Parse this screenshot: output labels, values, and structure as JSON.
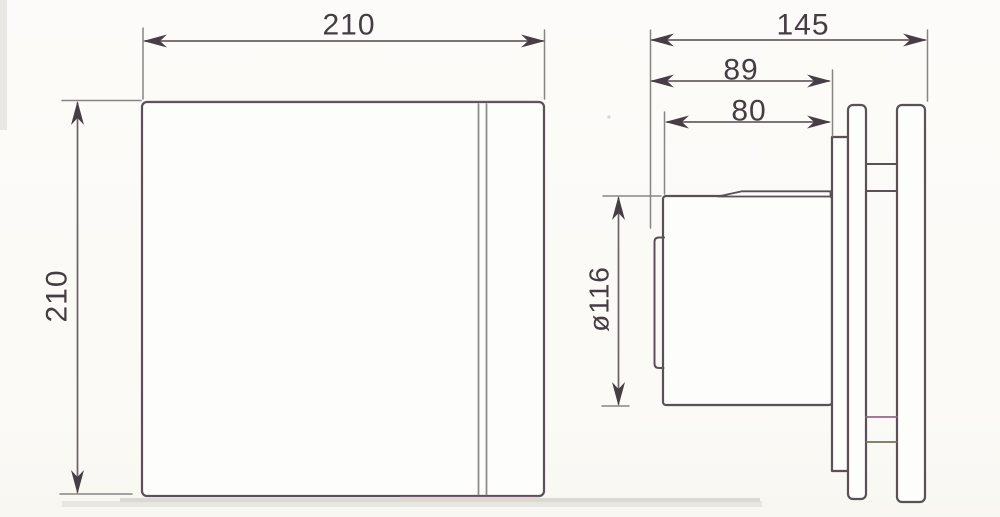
{
  "dimensions": {
    "front_width": {
      "label": "210"
    },
    "front_height": {
      "label": "210"
    },
    "side_total_depth": {
      "label": "145"
    },
    "side_depth_to_backplate": {
      "label": "89"
    },
    "side_duct_length": {
      "label": "80"
    },
    "side_duct_diameter": {
      "label": "ø116"
    }
  },
  "colors": {
    "main_line": "#5a5156",
    "dimension_line": "#6b6166",
    "extension_line": "#8a8386",
    "text": "#453d43",
    "panel_edge_line": "#908b8d",
    "tint_purple": "#94618b",
    "tint_olive": "#6f6d58",
    "background": "#fbfaf7"
  }
}
